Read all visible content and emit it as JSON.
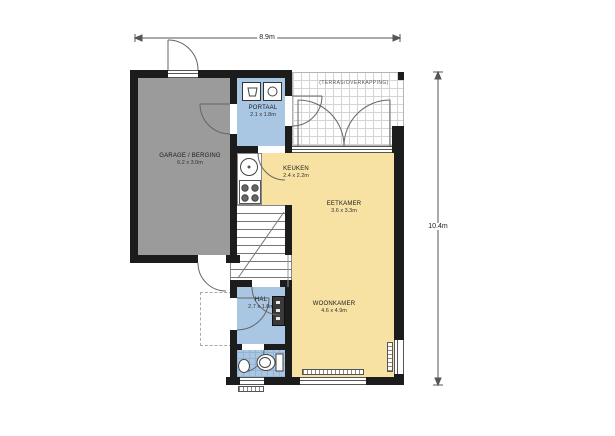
{
  "dimensions": {
    "width": "8.9m",
    "height": "10.4m"
  },
  "rooms": {
    "garage": {
      "name": "GARAGE / BERGING",
      "size": "6.2 x 3.0m"
    },
    "portaal": {
      "name": "PORTAAL",
      "size": "2.1 x 1.8m"
    },
    "keuken": {
      "name": "KEUKEN",
      "size": "2.4 x 2.2m"
    },
    "eetkamer": {
      "name": "EETKAMER",
      "size": "3.6 x 3.3m"
    },
    "woonkamer": {
      "name": "WOONKAMER",
      "size": "4.6 x 4.9m"
    },
    "hal": {
      "name": "HAL",
      "size": "2.7 x 1.8m"
    },
    "terras": {
      "name": "(TERRAS/OVERKAPPING)"
    }
  },
  "colors": {
    "wall": "#1c1c1c",
    "garage_floor": "#9b9b9b",
    "wet_room_floor": "#a9c6e2",
    "living_floor": "#f7e2a3",
    "terras_grid": "#d4d4d4",
    "thin_line": "#666666"
  },
  "fixtures": [
    "laundry-basket",
    "washing-machine",
    "kitchen-sink",
    "stove",
    "stairs",
    "toilet",
    "hand-basin",
    "radiator",
    "doormat",
    "meter-cabinet"
  ]
}
